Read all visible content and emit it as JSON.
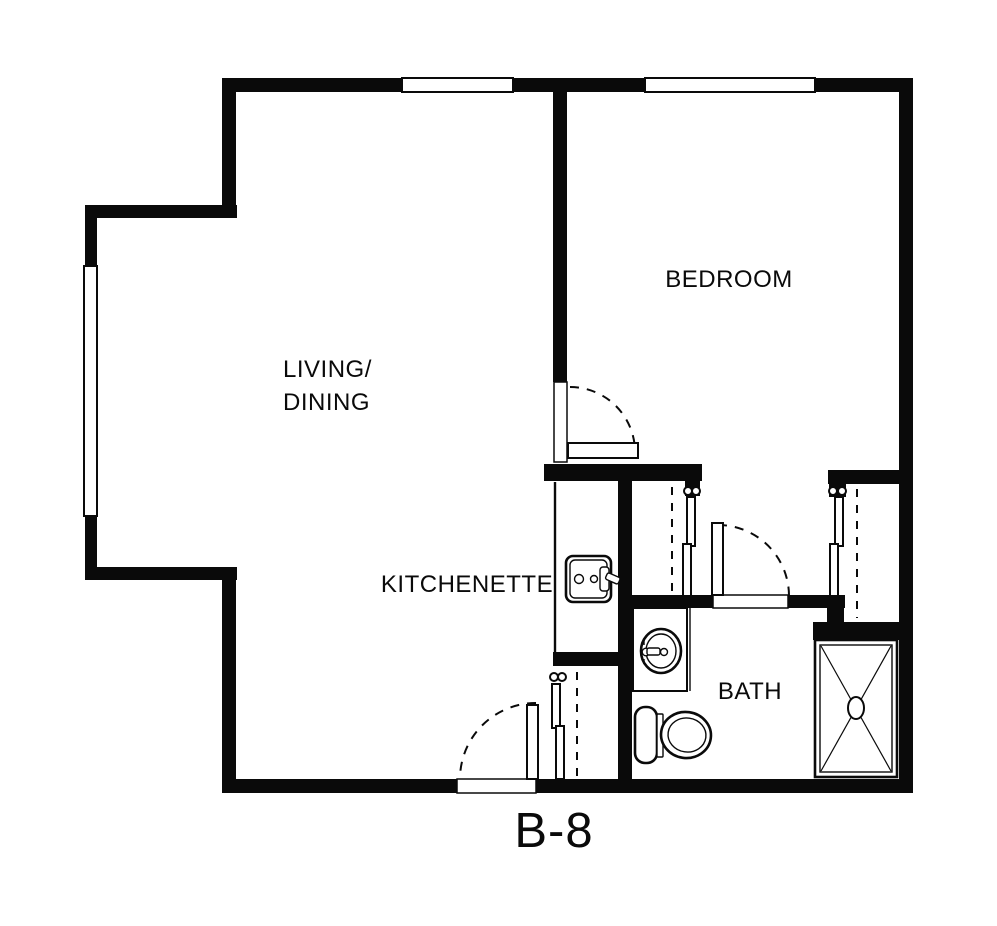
{
  "plan": {
    "code": "B-8",
    "rooms": {
      "living_dining_line1": "LIVING/",
      "living_dining_line2": "DINING",
      "bedroom": "BEDROOM",
      "kitchenette": "KITCHENETTE",
      "bath": "BATH"
    },
    "fixtures": [
      "kitchen-sink",
      "bath-sink",
      "toilet",
      "shower",
      "closet-rod",
      "door-swing"
    ],
    "colors": {
      "wall": "#0a0a0a",
      "background": "#ffffff"
    }
  }
}
